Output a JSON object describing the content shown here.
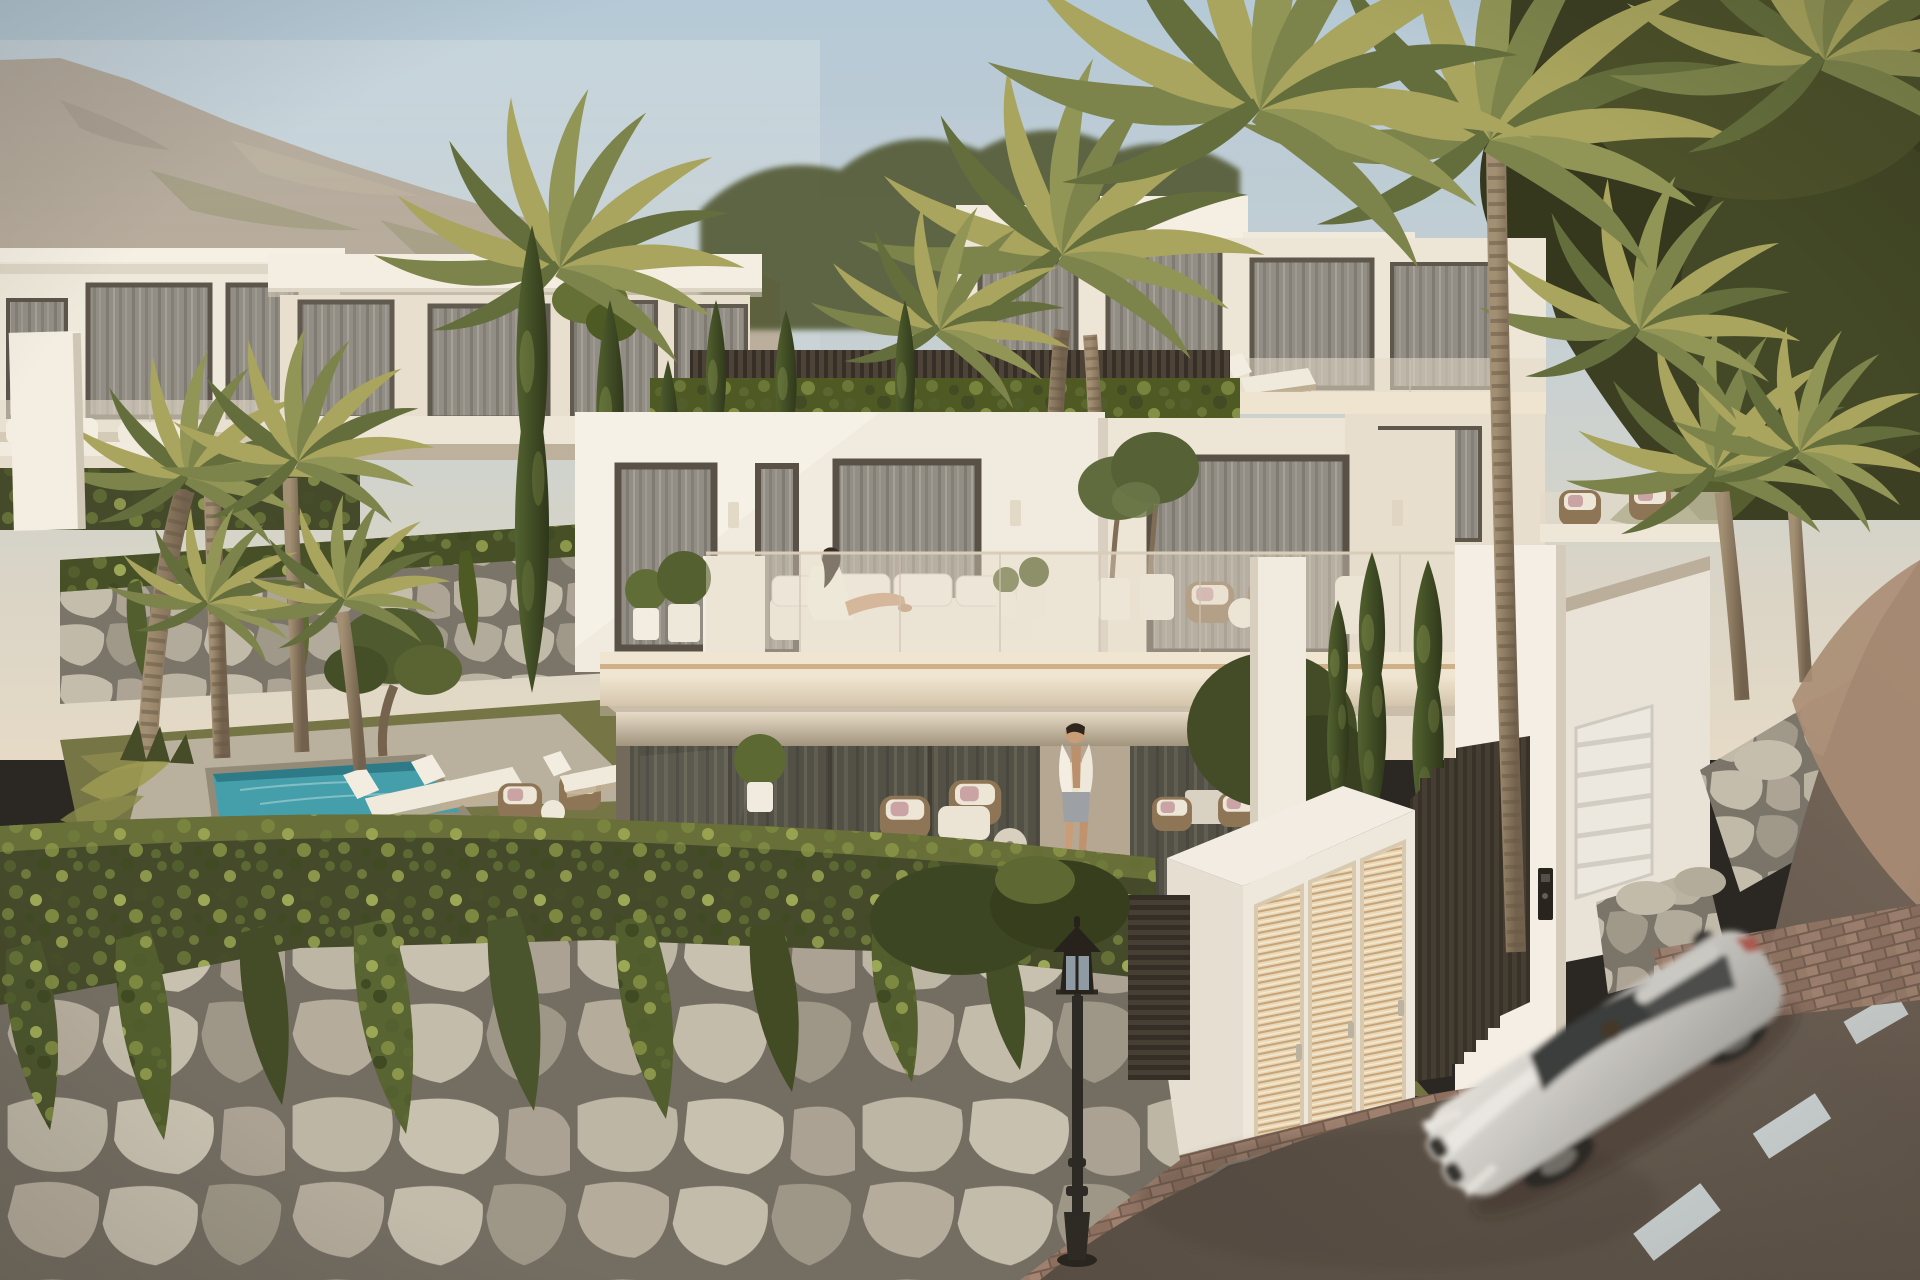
{
  "meta": {
    "title": "Modern hillside villas at golden hour",
    "type": "3d-architectural-render",
    "resolution": "1920x1280"
  },
  "palette": {
    "sky_top": "#b3cbdd",
    "sky_low": "#e7ddcc",
    "mountain": "#a89f92",
    "villa_white": "#f2efe7",
    "villa_bright": "#f7f4ec",
    "villa_shadow": "#ded6c8",
    "glass_dark": "#4b4a43",
    "curtain_grey": "#908e88",
    "slab_cream": "#f2e9d7",
    "accent_wood": "#c8a87e",
    "pool_water": "#3b9fb0",
    "grass_green": "#6f7244",
    "hedge_green": "#3c4527",
    "ivy_green": "#55642f",
    "palm_yellow": "#a6a55e",
    "palm_green": "#6d7c46",
    "cypress_green": "#31401f",
    "stone_light": "#b8b3a5",
    "stone_gap": "#75716a",
    "wall_panel": "#f5f2ea",
    "louver_cream": "#ead9ba",
    "fence_dark": "#332e29",
    "road_dark": "#5c534b",
    "road_light": "#a78b75",
    "lane_marking": "#cfdade",
    "sidewalk_brick": "#8d7062",
    "curb_grey": "#4c4844",
    "lamp_black": "#1f1d1b",
    "car_silver": "#c9cac8",
    "skin_tan": "#c99d7b",
    "robe_white": "#f7f4ed",
    "shorts_grey": "#9aa0a8"
  },
  "scene": {
    "sky": {
      "description": "clear pale-blue sky fading into warm golden haze"
    },
    "mountain": {
      "position": "upper-left",
      "description": "rocky scrub-covered ridge"
    },
    "villas": {
      "count": 6,
      "style": "modern white cubic volumes",
      "features": [
        "flat roofs",
        "glass balustrades",
        "floor-to-ceiling curtained windows",
        "sun terraces"
      ]
    },
    "central_villa": {
      "floors": 2,
      "terrace_furniture": [
        "modular white sofa",
        "potted shrubs",
        "potted olive trees",
        "wicker lounge chairs",
        "round side table",
        "chaise"
      ],
      "lower_floor": [
        "glass sliding walls",
        "beige stone pier with sconce",
        "wicker patio seating",
        "round coffee table",
        "outdoor dining set"
      ]
    },
    "people": [
      {
        "id": "woman-on-terrace",
        "description": "woman in a white robe reclining on the terrace sofa, face to the sun"
      },
      {
        "id": "man-on-patio",
        "description": "man in an open white shirt and grey shorts walking on the lower patio"
      }
    ],
    "pool": {
      "shape": "rectangular plunge pool",
      "deck": "stone paving",
      "loungers": 2
    },
    "vegetation": {
      "palms": "clusters of date palms with textured trunks",
      "cypresses": "columnar Italian cypresses",
      "olive_trees": 3,
      "ivy": "cascading over stone retaining walls",
      "hedges": "clipped dark-green hedges"
    },
    "street": {
      "road": "dark asphalt curving uphill to the right",
      "lane_markings": 3,
      "sidewalk": "red-brown brick pavers",
      "street_lamp": "black classic lantern post"
    },
    "gate": {
      "louvered_doors": 3,
      "finish": "cream louvers in white frame",
      "fence": "dark vertical-slat fence with stepped top",
      "intercom": true
    },
    "garage": {
      "door": "white ribbed sectional door"
    },
    "vehicle": {
      "type": "silver sports coupe",
      "state": "in motion with blur",
      "driver_visible": true,
      "badge": "roundel"
    }
  }
}
